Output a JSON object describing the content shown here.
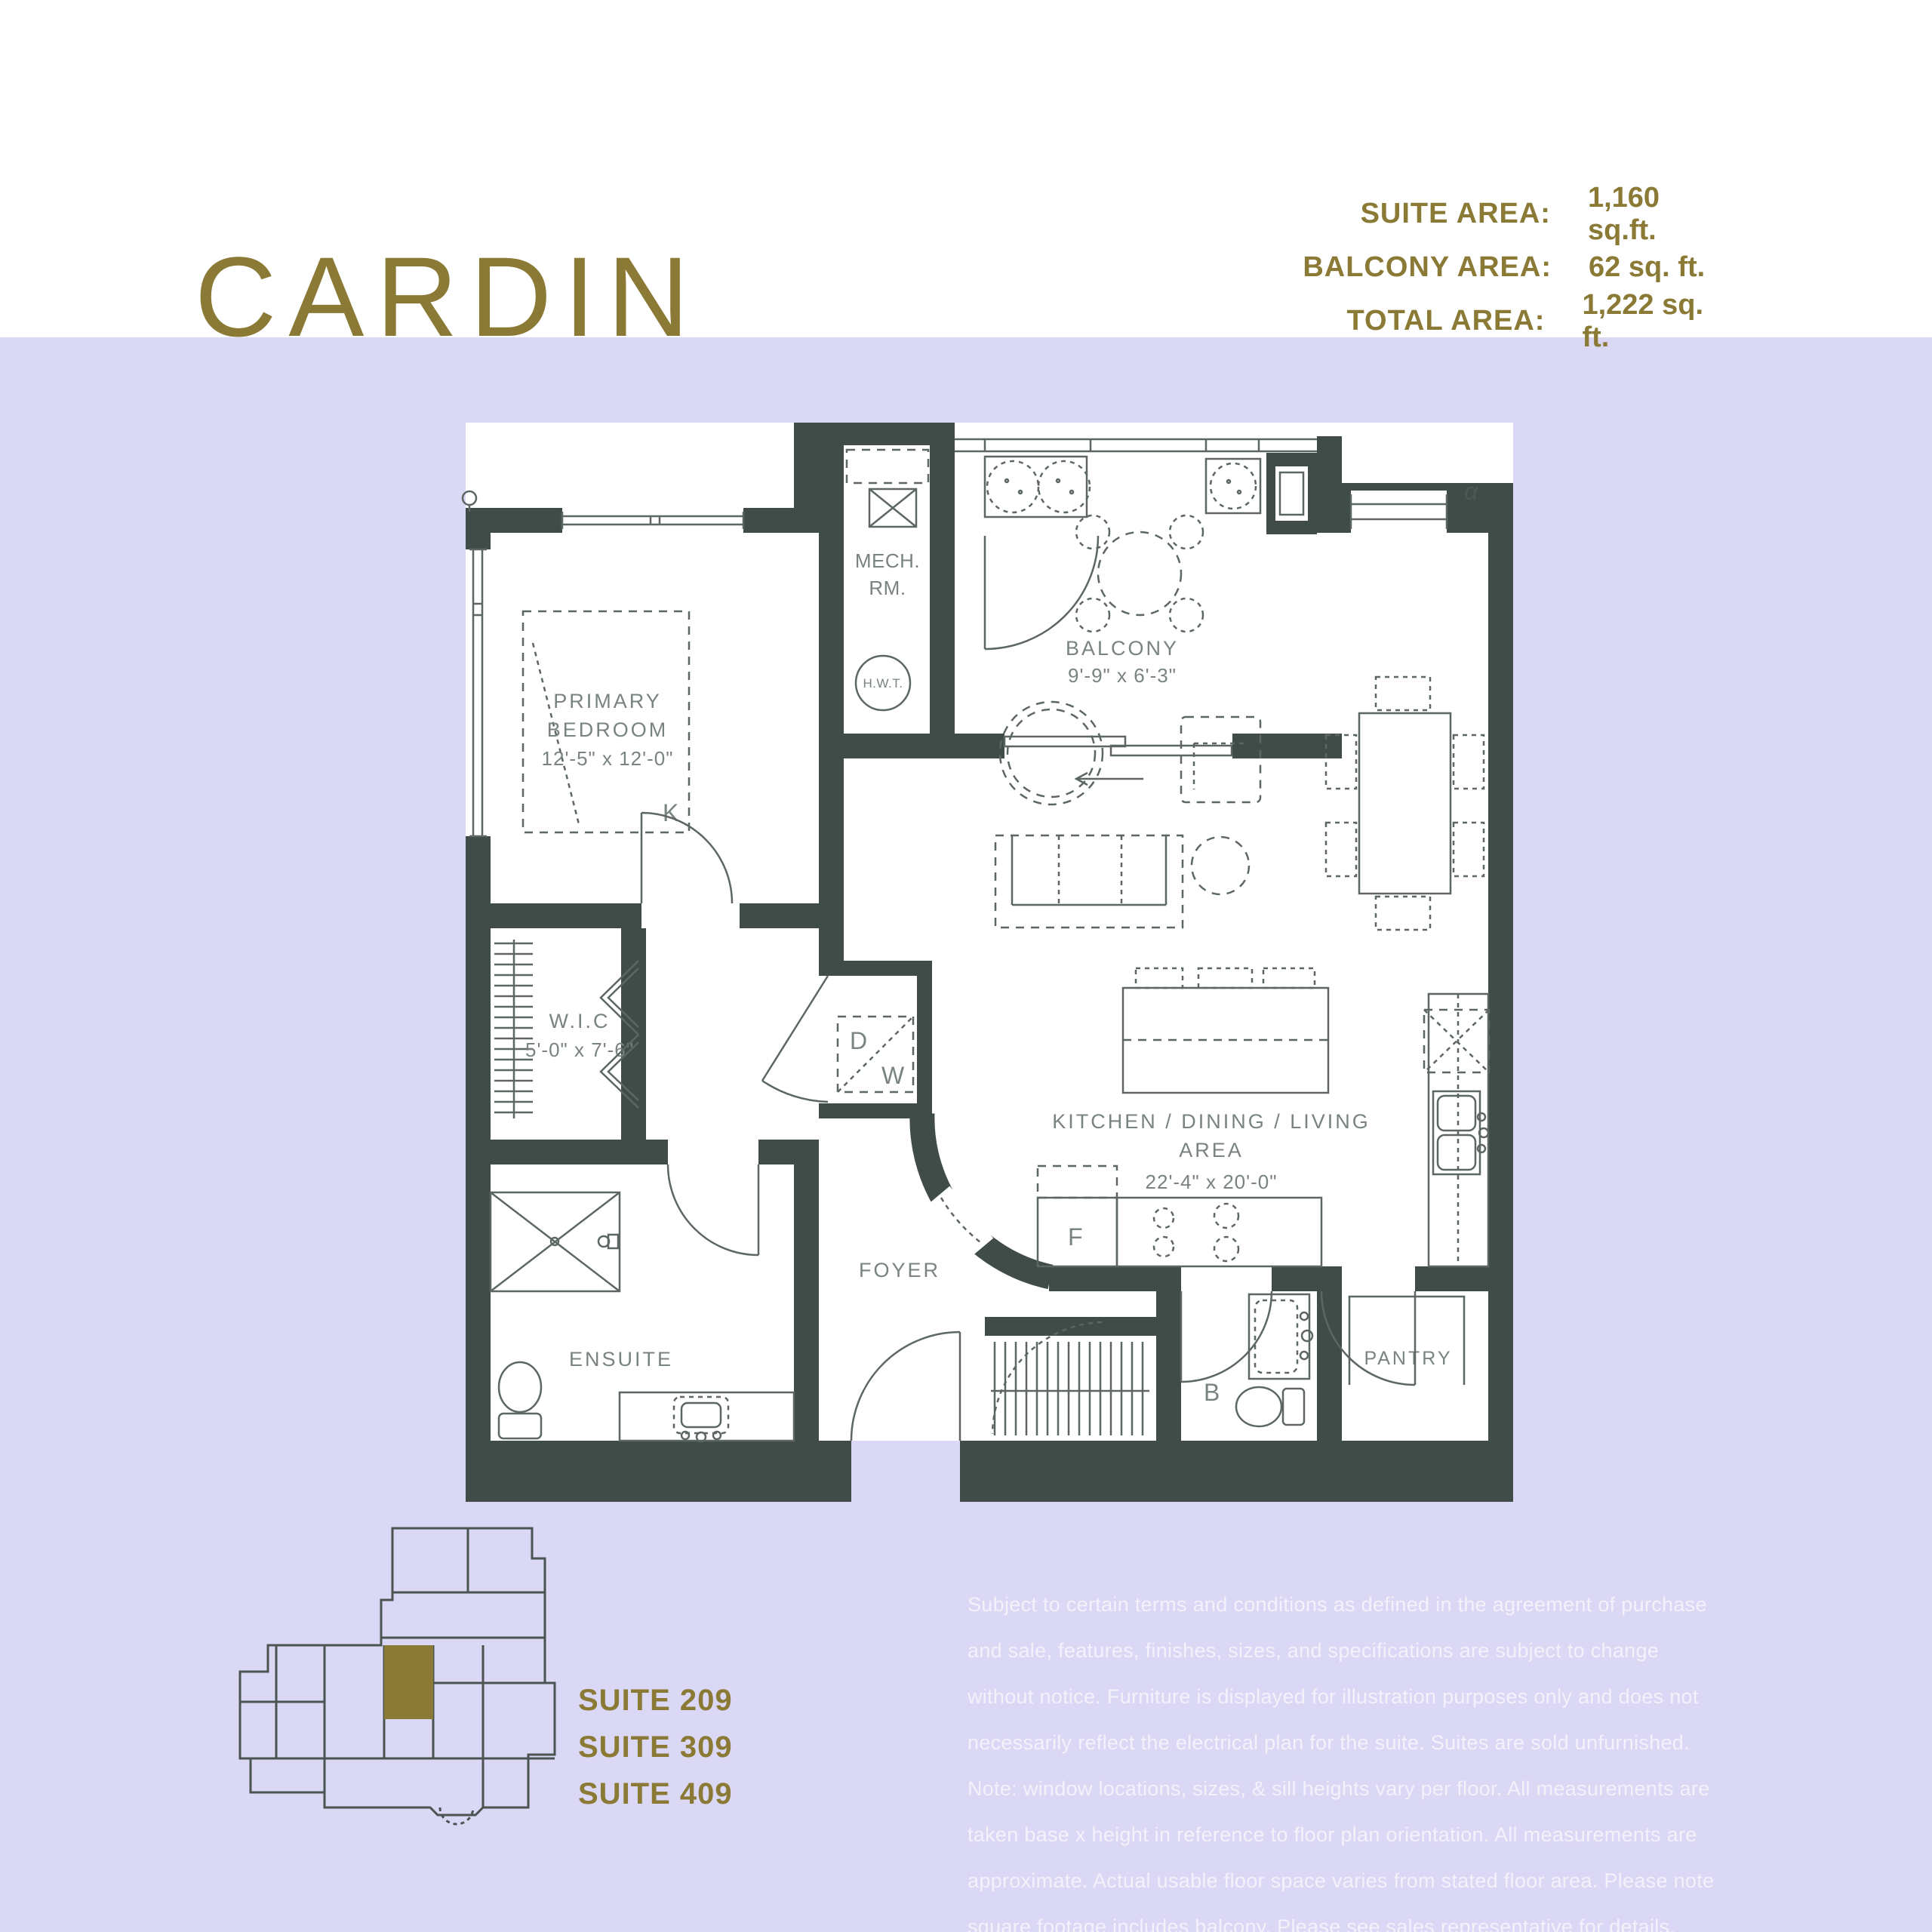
{
  "header": {
    "title": "CARDIN",
    "areas": {
      "rows": [
        {
          "label": "SUITE AREA:",
          "value": "1,160 sq.ft."
        },
        {
          "label": "BALCONY AREA:",
          "value": "62 sq. ft."
        },
        {
          "label": "TOTAL AREA:",
          "value": "1,222 sq. ft."
        }
      ]
    }
  },
  "floorplan": {
    "mech_room": {
      "line1": "MECH.",
      "line2": "RM."
    },
    "hwt": "H.W.T.",
    "balcony": {
      "name": "BALCONY",
      "dims": "9'-9\" x 6'-3\""
    },
    "primary_bedroom": {
      "line1": "PRIMARY",
      "line2": "BEDROOM",
      "dims": "12'-5\" x 12'-0\"",
      "bed_size_letter": "K"
    },
    "wic": {
      "name": "W.I.C",
      "dims": "5'-0\" x 7'-6\""
    },
    "laundry": {
      "dryer": "D",
      "washer": "W"
    },
    "ensuite": {
      "name": "ENSUITE"
    },
    "foyer": {
      "name": "FOYER"
    },
    "kitchen": {
      "line1": "KITCHEN / DINING / LIVING",
      "line2": "AREA",
      "dims": "22'-4\" x 20'-0\"",
      "fridge_letter": "F"
    },
    "bath": {
      "name": "B"
    },
    "pantry": {
      "name": "PANTRY"
    },
    "orientation_mark": "α"
  },
  "keyplan": {
    "suites": [
      "SUITE 209",
      "SUITE 309",
      "SUITE 409"
    ]
  },
  "disclaimer": "Subject to certain terms and conditions as defined in the agreement of purchase and sale, features, finishes, sizes, and specifications are subject to change without notice. Furniture is displayed for illustration purposes only and does not necessarily reflect the electrical plan for the suite. Suites are sold unfurnished. Note: window locations, sizes, & sill heights vary per floor. All measurements are taken base x height in reference to floor plan orientation. All measurements are approximate. Actual usable floor space varies from stated floor area. Please note square footage includes balcony. Please see sales representative for details. E&OE.",
  "colors": {
    "gold": "#8a7a35",
    "wall": "#3f4c48",
    "background_lavender": "#dbd8f5",
    "fixture_line": "#5c6764",
    "room_label": "#79837f",
    "disclaimer_text": "#f3f2fb"
  }
}
